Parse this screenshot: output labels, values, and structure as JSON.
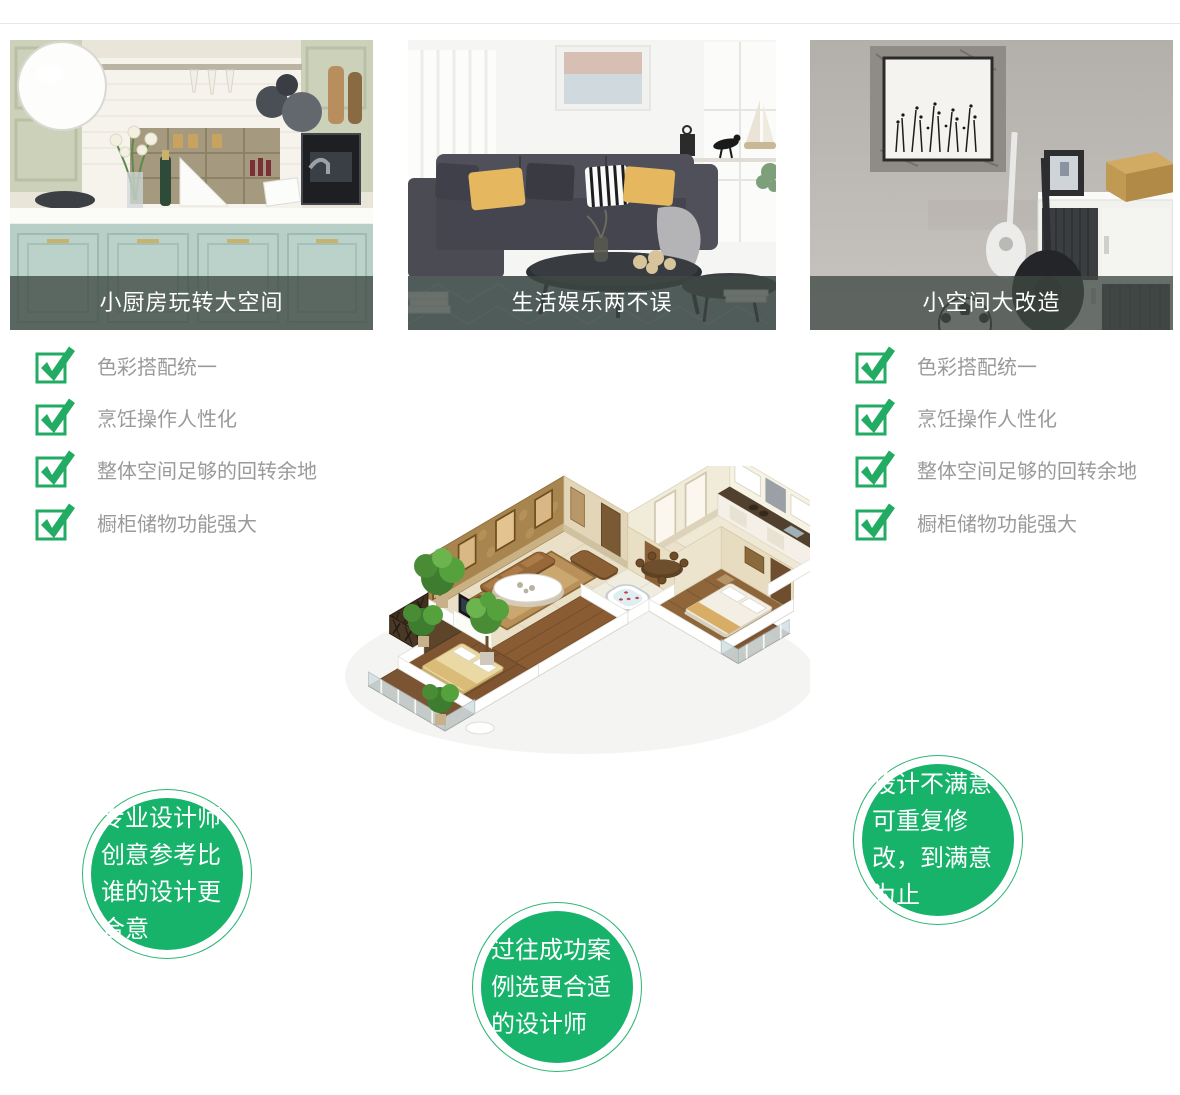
{
  "colors": {
    "accent_green": "#22ab63",
    "bubble_green": "#17b36b",
    "bubble_ring": "#2bb673",
    "caption_bg": "rgba(64,73,68,0.78)",
    "checklist_text": "#9a9a9a"
  },
  "cards": [
    {
      "caption": "小厨房玩转大空间",
      "scene": "kitchen"
    },
    {
      "caption": "生活娱乐两不误",
      "scene": "living-room"
    },
    {
      "caption": "小空间大改造",
      "scene": "small-space"
    }
  ],
  "checklist": {
    "items": [
      "色彩搭配统一",
      "烹饪操作人性化",
      "整体空间足够的回转余地",
      "橱柜储物功能强大"
    ]
  },
  "bubbles": [
    {
      "text": "专业设计师创意参考比谁的设计更合意"
    },
    {
      "text": "过往成功案例选更合适的设计师"
    },
    {
      "text": "设计不满意可重复修改，到满意为止"
    }
  ],
  "floorplan": {
    "label": "3d-apartment-floorplan"
  }
}
